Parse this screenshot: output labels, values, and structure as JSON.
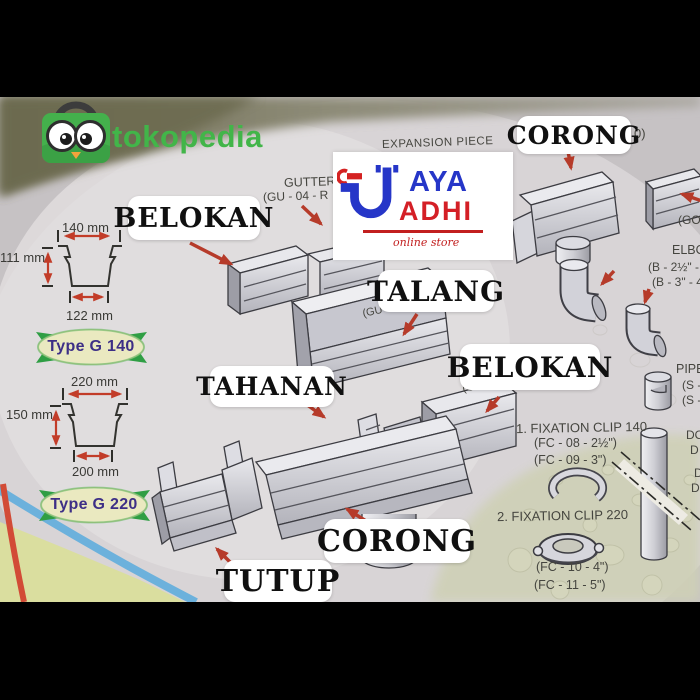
{
  "branding": {
    "marketplace_logo_text": "tokopedia",
    "store_logo": {
      "top_word": "AYA",
      "bottom_word": "ADHI",
      "tagline": "online store"
    }
  },
  "callouts": [
    {
      "id": "corong-top",
      "text": "CORONG"
    },
    {
      "id": "belokan-left",
      "text": "BELOKAN"
    },
    {
      "id": "talang",
      "text": "TALANG"
    },
    {
      "id": "belokan-right",
      "text": "BELOKAN"
    },
    {
      "id": "tahanan",
      "text": "TAHANAN"
    },
    {
      "id": "corong-bottom",
      "text": "CORONG"
    },
    {
      "id": "tutup",
      "text": "TUTUP"
    }
  ],
  "annotations": {
    "expansion_piece": "EXPANSION PIECE",
    "gutter_label": "GUTTER",
    "gutter_code": "(GU - 04 - R",
    "corong_code_fragment": "0)",
    "go_fragment": "(GO",
    "elbow_label": "ELBOW",
    "elbow_code_1": "(B - 2½\" -",
    "elbow_code_2": "(B - 3\" - 4",
    "pipe_label": "PIPE",
    "pipe_code_1": "(S -",
    "pipe_code_2": "(S -",
    "talang_code": "(GU - 01 - R -",
    "belokan_code": "(GU - 03 - R -",
    "fixation_140_title": "1. FIXATION CLIP 140",
    "fixation_140_code_1": "(FC - 08 - 2½\")",
    "fixation_140_code_2": "(FC - 09 - 3\")",
    "fixation_220_title": "2. FIXATION CLIP 220",
    "fixation_220_code_1": "(FC - 10 - 4\")",
    "fixation_220_code_2": "(FC - 11 - 5\")",
    "down_pipe_fragment_1": "DO",
    "down_pipe_fragment_2": "D",
    "down_pipe_fragment_3": "DO",
    "down_pipe_fragment_4": "DO"
  },
  "profiles": [
    {
      "id": "g140",
      "top_width": "140 mm",
      "height": "111 mm",
      "bottom_width": "122 mm",
      "type_label": "Type G 140"
    },
    {
      "id": "g220",
      "top_width": "220 mm",
      "height": "150 mm",
      "bottom_width": "200 mm",
      "type_label": "Type G 220"
    }
  ],
  "colors": {
    "arrow_red": "#b63b2a",
    "tokopedia_green": "#42b549",
    "jaya_blue": "#2636c8",
    "adhi_red": "#d41f26",
    "ribbon_green": "#2f9e44",
    "ribbon_text": "#3d2f86",
    "letterbox": "#000000"
  }
}
